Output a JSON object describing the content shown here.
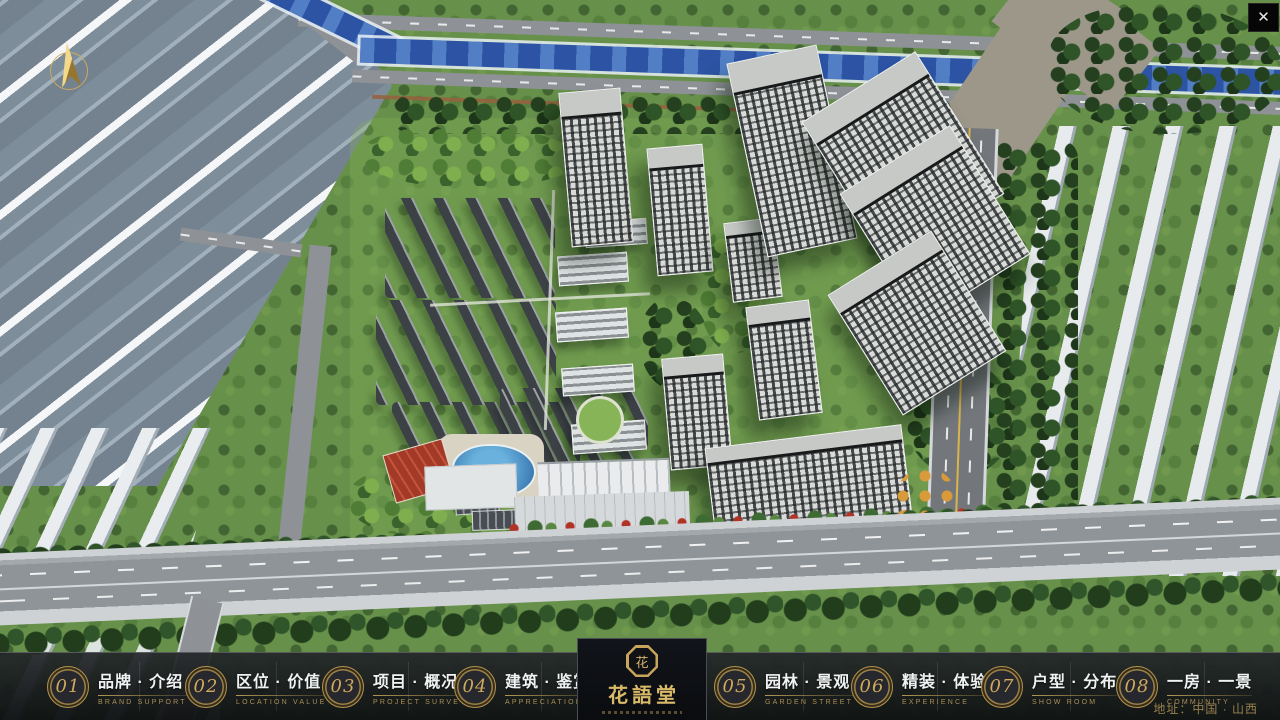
{
  "window": {
    "close_label": "✕"
  },
  "nav": {
    "items": [
      {
        "number": "01",
        "label_zh": "品牌 · 介绍",
        "label_en": "BRAND SUPPORT"
      },
      {
        "number": "02",
        "label_zh": "区位 · 价值",
        "label_en": "LOCATION VALUE"
      },
      {
        "number": "03",
        "label_zh": "项目 · 概况",
        "label_en": "PROJECT SURVEY"
      },
      {
        "number": "04",
        "label_zh": "建筑 · 鉴赏",
        "label_en": "APPRECIATION"
      },
      {
        "number": "05",
        "label_zh": "园林 · 景观",
        "label_en": "GARDEN STREET"
      },
      {
        "number": "06",
        "label_zh": "精装 · 体验",
        "label_en": "EXPERIENCE"
      },
      {
        "number": "07",
        "label_zh": "户型 · 分布",
        "label_en": "SHOW ROOM"
      },
      {
        "number": "08",
        "label_zh": "一房 · 一景",
        "label_en": "COMMUNITY"
      }
    ]
  },
  "logo": {
    "name_zh": "花語堂",
    "seal_char": "花"
  },
  "footer": {
    "address": "地址：中国 · 山西"
  },
  "colors": {
    "gold": "#c9a55c",
    "bar_bg": "#141619",
    "river_blue": "#2c53a4"
  }
}
